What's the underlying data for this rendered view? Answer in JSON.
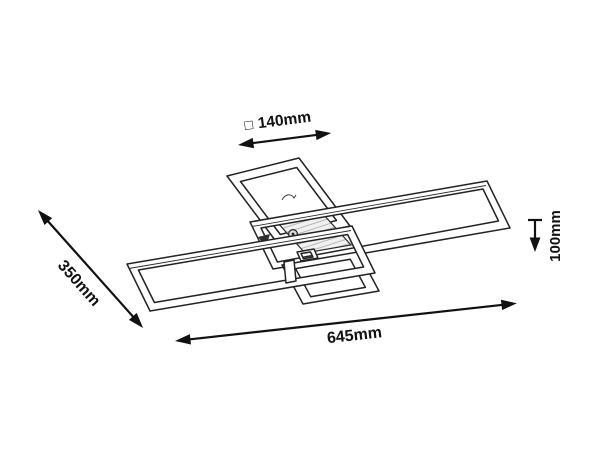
{
  "colors": {
    "line": "#1f1f1f",
    "text": "#111111",
    "background": "#ffffff",
    "hatch": "#a8a8a8"
  },
  "dimensions": {
    "canopy": {
      "symbol": "□",
      "value": "140mm"
    },
    "depth": {
      "value": "350mm"
    },
    "length": {
      "value": "645mm"
    },
    "height": {
      "value": "100mm"
    }
  }
}
